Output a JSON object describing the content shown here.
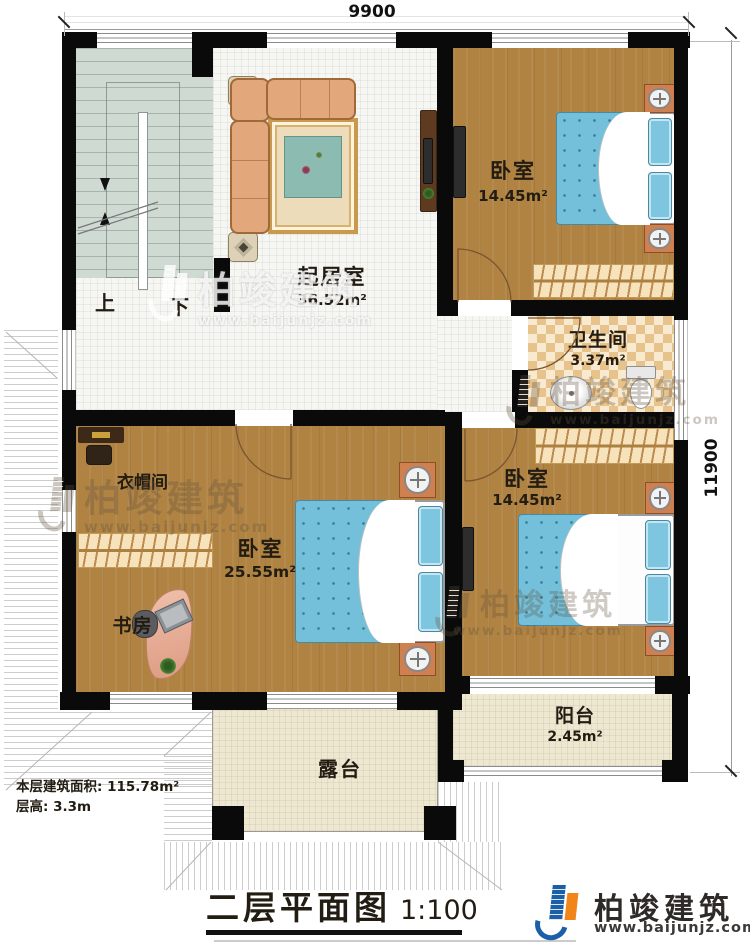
{
  "dimensions": {
    "top": "9900",
    "right": "11900"
  },
  "stairs": {
    "up": "上",
    "down": "下"
  },
  "rooms": {
    "living": {
      "name": "起居室",
      "area": "36.52m²"
    },
    "bedroom_top_right": {
      "name": "卧室",
      "area": "14.45m²"
    },
    "bathroom": {
      "name": "卫生间",
      "area": "3.37m²"
    },
    "cloakroom": {
      "name": "衣帽间"
    },
    "bedroom_master": {
      "name": "卧室",
      "area": "25.55m²"
    },
    "study": {
      "name": "书房"
    },
    "bedroom_bottom_right": {
      "name": "卧室",
      "area": "14.45m²"
    },
    "balcony": {
      "name": "阳台",
      "area": "2.45m²"
    },
    "terrace": {
      "name": "露台"
    }
  },
  "footer": {
    "floor_area": "本层建筑面积: 115.78m²",
    "floor_height": "层高: 3.3m",
    "title": "二层平面图",
    "scale": "1:100"
  },
  "brand": {
    "name": "柏竣建筑",
    "url": "www.baijunjz.com"
  },
  "watermark": {
    "name": "柏竣建筑",
    "url": "www.baijunjz.com"
  },
  "colors": {
    "accent_blue": "#1a5fa8",
    "accent_orange": "#f08519",
    "bed_blue": "#74c0da",
    "wood": "#b08343",
    "wall": "#0a0a0a"
  }
}
